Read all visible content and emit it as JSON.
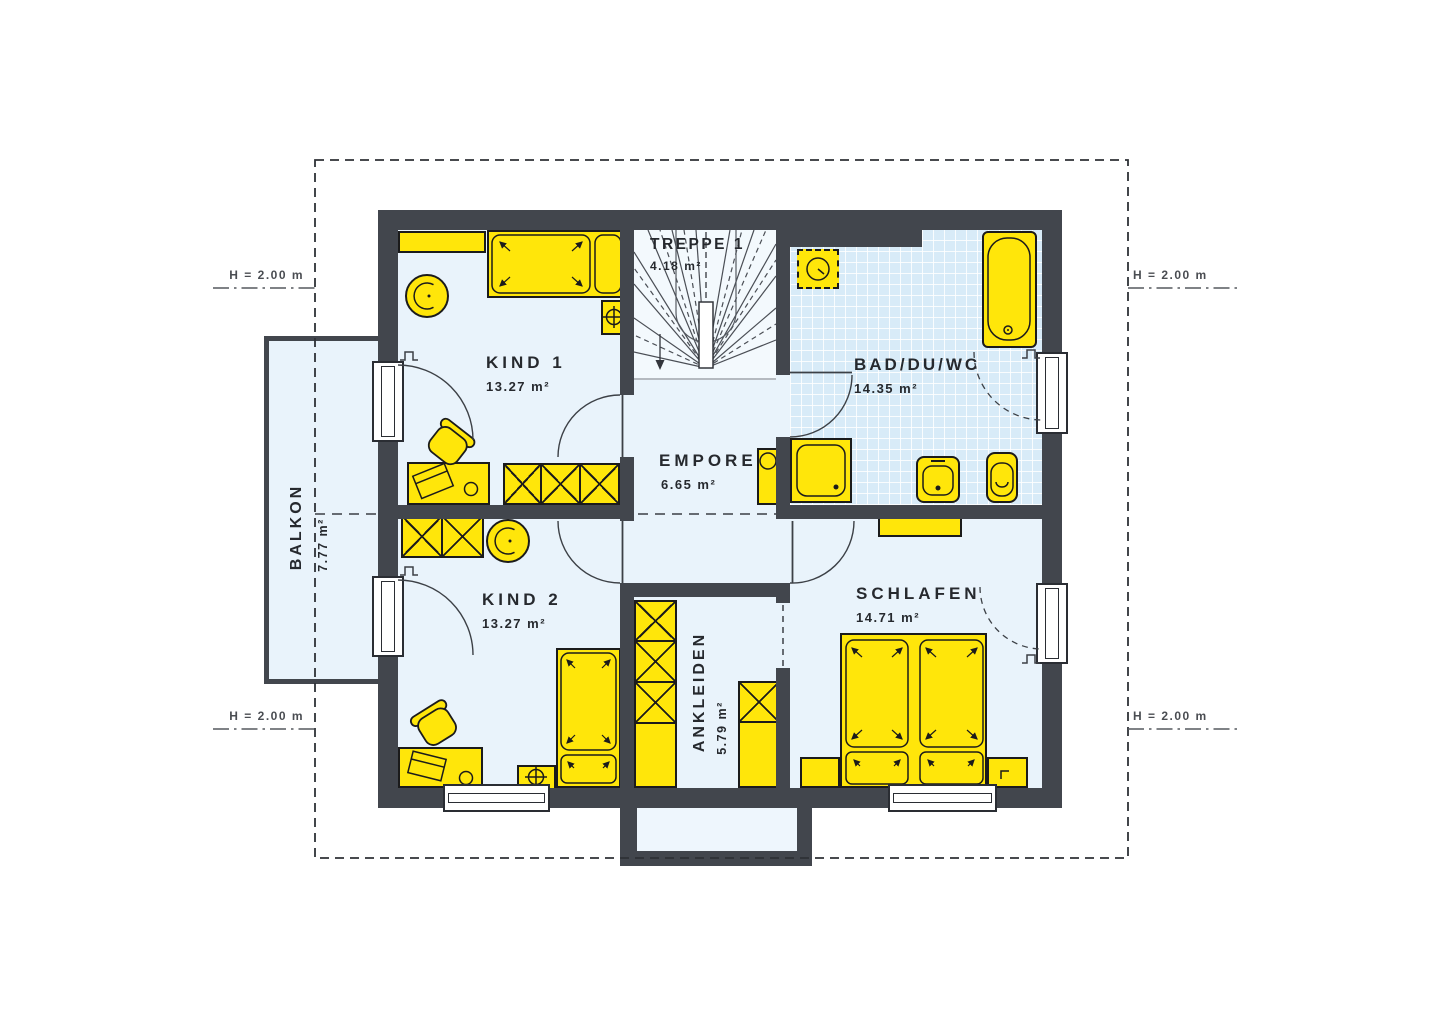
{
  "plan_title": "Obergeschoss Grundriss",
  "rooms": {
    "treppe": {
      "label": "TREPPE 1",
      "area": "4.18 m²"
    },
    "kind1": {
      "label": "KIND 1",
      "area": "13.27 m²"
    },
    "bad": {
      "label": "BAD/DU/WC",
      "area": "14.35 m²"
    },
    "empore": {
      "label": "EMPORE",
      "area": "6.65 m²"
    },
    "kind2": {
      "label": "KIND 2",
      "area": "13.27 m²"
    },
    "schlafen": {
      "label": "SCHLAFEN",
      "area": "14.71 m²"
    },
    "ankleiden": {
      "label": "ANKLEIDEN",
      "area": "5.79 m²"
    },
    "balkon": {
      "label": "BALKON",
      "area": "7.77 m²"
    }
  },
  "annotations": {
    "height_top_left": "H = 2.00 m",
    "height_top_right": "H = 2.00 m",
    "height_bottom_left": "H = 2.00 m",
    "height_bottom_right": "H = 2.00 m"
  },
  "colors": {
    "furniture": "#ffe60a",
    "wall": "#42464d",
    "floor": "#e9f3fb",
    "tile": "#d8ebf8",
    "line": "#1b1b1b"
  }
}
